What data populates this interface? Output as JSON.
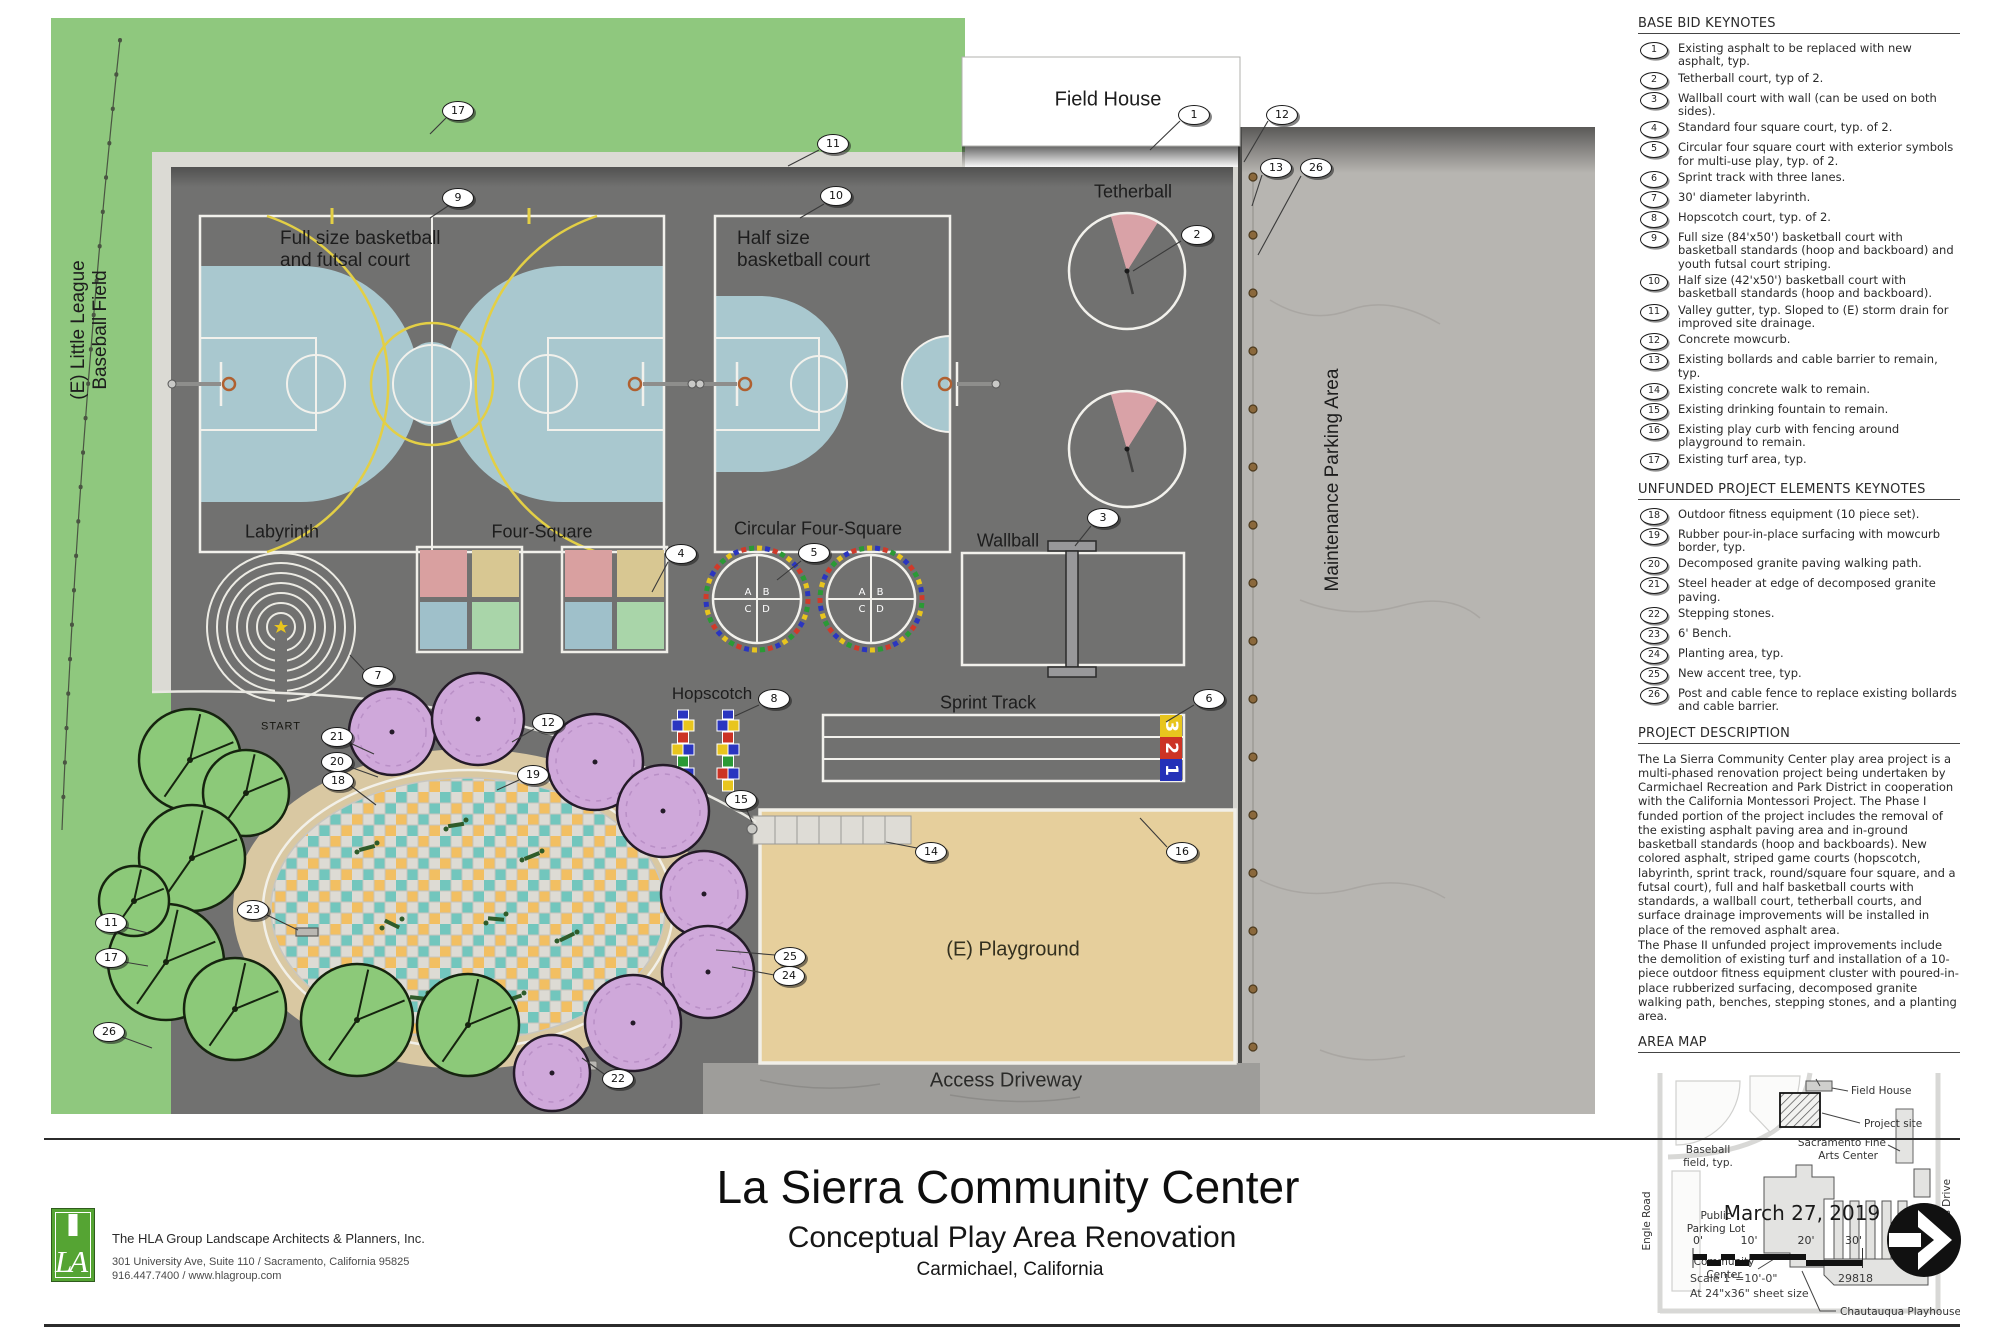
{
  "title_block": {
    "sheet_title": "La Sierra Community Center",
    "sheet_subtitle": "Conceptual Play Area Renovation",
    "sheet_location": "Carmichael, California",
    "date": "March 27, 2019",
    "firm_name": "The HLA Group Landscape Architects & Planners, Inc.",
    "firm_address": "301 University Ave, Suite 110 / Sacramento, California 95825",
    "firm_contact": "916.447.7400 / www.hlagroup.com",
    "logo_letters": "LA",
    "scale_label": "Scale 1\"=10'-0\"",
    "sheet_size_label": "At 24\"x36\" sheet size",
    "project_number": "29818",
    "scale_ticks": [
      "0'",
      "10'",
      "20'",
      "30'"
    ]
  },
  "sidebar": {
    "base_bid_heading": "BASE BID KEYNOTES",
    "base_bid_keynotes": [
      {
        "n": "1",
        "text": "Existing asphalt to be replaced with new asphalt, typ."
      },
      {
        "n": "2",
        "text": "Tetherball court, typ of 2."
      },
      {
        "n": "3",
        "text": "Wallball court with wall (can be used on both sides)."
      },
      {
        "n": "4",
        "text": "Standard four square court, typ. of 2."
      },
      {
        "n": "5",
        "text": "Circular four square court with exterior symbols for multi-use play, typ. of 2."
      },
      {
        "n": "6",
        "text": "Sprint track with three lanes."
      },
      {
        "n": "7",
        "text": "30' diameter labyrinth."
      },
      {
        "n": "8",
        "text": "Hopscotch court, typ. of 2."
      },
      {
        "n": "9",
        "text": "Full size (84'x50') basketball court with basketball standards (hoop and backboard) and youth futsal court striping."
      },
      {
        "n": "10",
        "text": "Half size (42'x50') basketball court with basketball standards (hoop and backboard)."
      },
      {
        "n": "11",
        "text": "Valley gutter, typ. Sloped to (E) storm drain for improved site drainage."
      },
      {
        "n": "12",
        "text": "Concrete mowcurb."
      },
      {
        "n": "13",
        "text": "Existing bollards and cable barrier to remain, typ."
      },
      {
        "n": "14",
        "text": "Existing concrete walk to remain."
      },
      {
        "n": "15",
        "text": "Existing drinking fountain to remain."
      },
      {
        "n": "16",
        "text": "Existing play curb with fencing around playground to remain."
      },
      {
        "n": "17",
        "text": "Existing turf area, typ."
      }
    ],
    "unfunded_heading": "UNFUNDED PROJECT ELEMENTS KEYNOTES",
    "unfunded_keynotes": [
      {
        "n": "18",
        "text": "Outdoor fitness equipment (10 piece set)."
      },
      {
        "n": "19",
        "text": "Rubber pour-in-place surfacing with mowcurb border, typ."
      },
      {
        "n": "20",
        "text": "Decomposed granite paving walking path."
      },
      {
        "n": "21",
        "text": "Steel header at edge of decomposed granite paving."
      },
      {
        "n": "22",
        "text": "Stepping stones."
      },
      {
        "n": "23",
        "text": "6' Bench."
      },
      {
        "n": "24",
        "text": "Planting area, typ."
      },
      {
        "n": "25",
        "text": "New accent tree, typ."
      },
      {
        "n": "26",
        "text": "Post and cable fence to replace existing bollards and cable barrier."
      }
    ],
    "description_heading": "PROJECT DESCRIPTION",
    "description_p1": "The La Sierra Community Center play area project is a multi-phased renovation project being undertaken by Carmichael Recreation and Park District in cooperation with the California Montessori Project. The Phase I funded portion of the project includes the removal of the existing asphalt paving area and in-ground basketball standards (hoop and backboards). New colored asphalt, striped game courts (hopscotch, labyrinth, sprint track, round/square four square, and a futsal court), full and half basketball courts with standards, a wallball court, tetherball courts, and surface drainage improvements will be installed in place of the removed asphalt area.",
    "description_p2": "The Phase II unfunded project improvements include the demolition of existing turf and installation of a 10-piece outdoor fitness equipment cluster with poured-in-place rubberized surfacing, decomposed granite walking path, benches, stepping stones, and a planting area.",
    "area_map_heading": "AREA MAP",
    "area_map_labels": {
      "baseball_l1": "Baseball",
      "baseball_l2": "field, typ.",
      "field_house": "Field House",
      "project_site": "Project site",
      "arts_l1": "Sacramento Fine",
      "arts_l2": "Arts Center",
      "engle_road": "Engle Road",
      "parking_l1": "Public",
      "parking_l2": "Parking Lot",
      "community_l1": "Community",
      "community_l2": "Center",
      "gibbons_drive": "Gibbons Drive",
      "chautauqua": "Chautauqua Playhouse"
    }
  },
  "plan": {
    "labels": {
      "field_house": "Field House",
      "tetherball": "Tetherball",
      "full_court": "Full size basketball\nand futsal court",
      "half_court": "Half size\nbasketball court",
      "labyrinth": "Labyrinth",
      "start": "START",
      "four_square": "Four-Square",
      "circular_four_square": "Circular Four-Square",
      "wallball": "Wallball",
      "hopscotch": "Hopscotch",
      "sprint_track": "Sprint Track",
      "maintenance": "Maintenance Parking Area",
      "little_league": "(E) Little League\nBaseball Field",
      "playground": "(E) Playground",
      "access_driveway": "Access Driveway"
    },
    "circular_letters": [
      "A",
      "B",
      "C",
      "D"
    ],
    "sprint_lane_numbers": [
      "3",
      "2",
      "1"
    ],
    "bubbles": [
      {
        "n": "17",
        "x": 458,
        "y": 111
      },
      {
        "n": "1",
        "x": 1194,
        "y": 115
      },
      {
        "n": "12",
        "x": 1282,
        "y": 115
      },
      {
        "n": "11",
        "x": 833,
        "y": 144
      },
      {
        "n": "13",
        "x": 1276,
        "y": 168
      },
      {
        "n": "26",
        "x": 1316,
        "y": 168
      },
      {
        "n": "9",
        "x": 458,
        "y": 198
      },
      {
        "n": "10",
        "x": 836,
        "y": 196
      },
      {
        "n": "2",
        "x": 1197,
        "y": 235
      },
      {
        "n": "3",
        "x": 1103,
        "y": 518
      },
      {
        "n": "4",
        "x": 681,
        "y": 554
      },
      {
        "n": "5",
        "x": 814,
        "y": 553
      },
      {
        "n": "7",
        "x": 378,
        "y": 676
      },
      {
        "n": "8",
        "x": 774,
        "y": 699
      },
      {
        "n": "6",
        "x": 1209,
        "y": 699
      },
      {
        "n": "12",
        "x": 548,
        "y": 723
      },
      {
        "n": "21",
        "x": 337,
        "y": 737
      },
      {
        "n": "20",
        "x": 337,
        "y": 762
      },
      {
        "n": "19",
        "x": 533,
        "y": 775
      },
      {
        "n": "18",
        "x": 338,
        "y": 781
      },
      {
        "n": "15",
        "x": 741,
        "y": 800
      },
      {
        "n": "14",
        "x": 931,
        "y": 852
      },
      {
        "n": "16",
        "x": 1182,
        "y": 852
      },
      {
        "n": "23",
        "x": 253,
        "y": 910
      },
      {
        "n": "11",
        "x": 111,
        "y": 923
      },
      {
        "n": "25",
        "x": 790,
        "y": 957
      },
      {
        "n": "17",
        "x": 111,
        "y": 958
      },
      {
        "n": "24",
        "x": 789,
        "y": 976
      },
      {
        "n": "26",
        "x": 109,
        "y": 1032
      },
      {
        "n": "22",
        "x": 618,
        "y": 1079
      }
    ],
    "colors": {
      "turf": "#8fc87e",
      "asphalt": "#717170",
      "court_blue": "#a9c8cf",
      "futsal_yellow": "#e3cf45",
      "tetherball_pink": "#d9a2a7",
      "parking_concrete": "#b7b5b1",
      "playground_sand": "#e6cf9c",
      "dg_path": "#d9c8a2",
      "driveway": "#9e9d9a",
      "tree_green": "#8cc979",
      "tree_purple": "#cfa8da",
      "lane1_blue": "#2431b8",
      "lane2_red": "#cc3325",
      "lane3_yellow": "#e8c51e"
    }
  }
}
